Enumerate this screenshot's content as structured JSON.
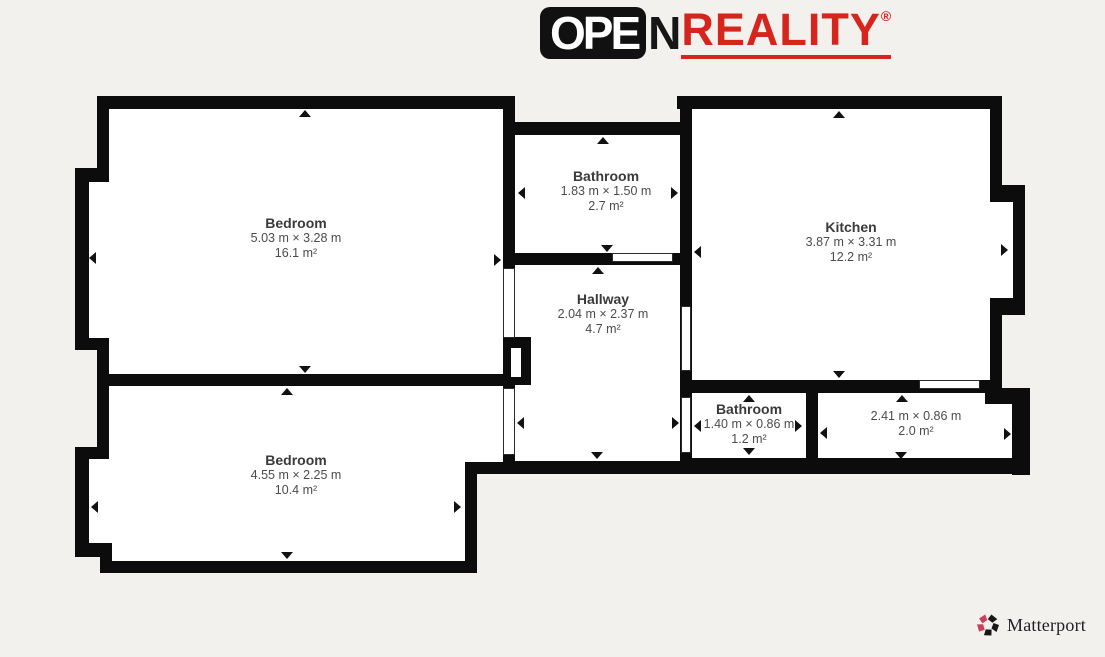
{
  "logo": {
    "open": "OPE",
    "n": "N",
    "reality": "REALITY",
    "reg": "®"
  },
  "rooms": [
    {
      "name": "Bedroom",
      "dims": "5.03 m × 3.28 m",
      "area": "16.1 m²"
    },
    {
      "name": "Bathroom",
      "dims": "1.83 m × 1.50 m",
      "area": "2.7 m²"
    },
    {
      "name": "Kitchen",
      "dims": "3.87 m × 3.31 m",
      "area": "12.2 m²"
    },
    {
      "name": "Hallway",
      "dims": "2.04 m × 2.37 m",
      "area": "4.7 m²"
    },
    {
      "name": "Bedroom",
      "dims": "4.55 m × 2.25 m",
      "area": "10.4 m²"
    },
    {
      "name": "Bathroom",
      "dims": "1.40 m × 0.86 m",
      "area": "1.2 m²"
    },
    {
      "name": "",
      "dims": "2.41 m × 0.86 m",
      "area": "2.0 m²"
    }
  ],
  "footer": {
    "brand": "Matterport"
  },
  "colors": {
    "background": "#f2f1ee",
    "wall": "#0c0c0c",
    "room_fill": "#ffffff",
    "logo_red": "#d5251d",
    "logo_black": "#161616",
    "matterport_pink": "#c8435a",
    "matterport_text": "#1e1e24",
    "label_text": "#3d3d3d"
  }
}
